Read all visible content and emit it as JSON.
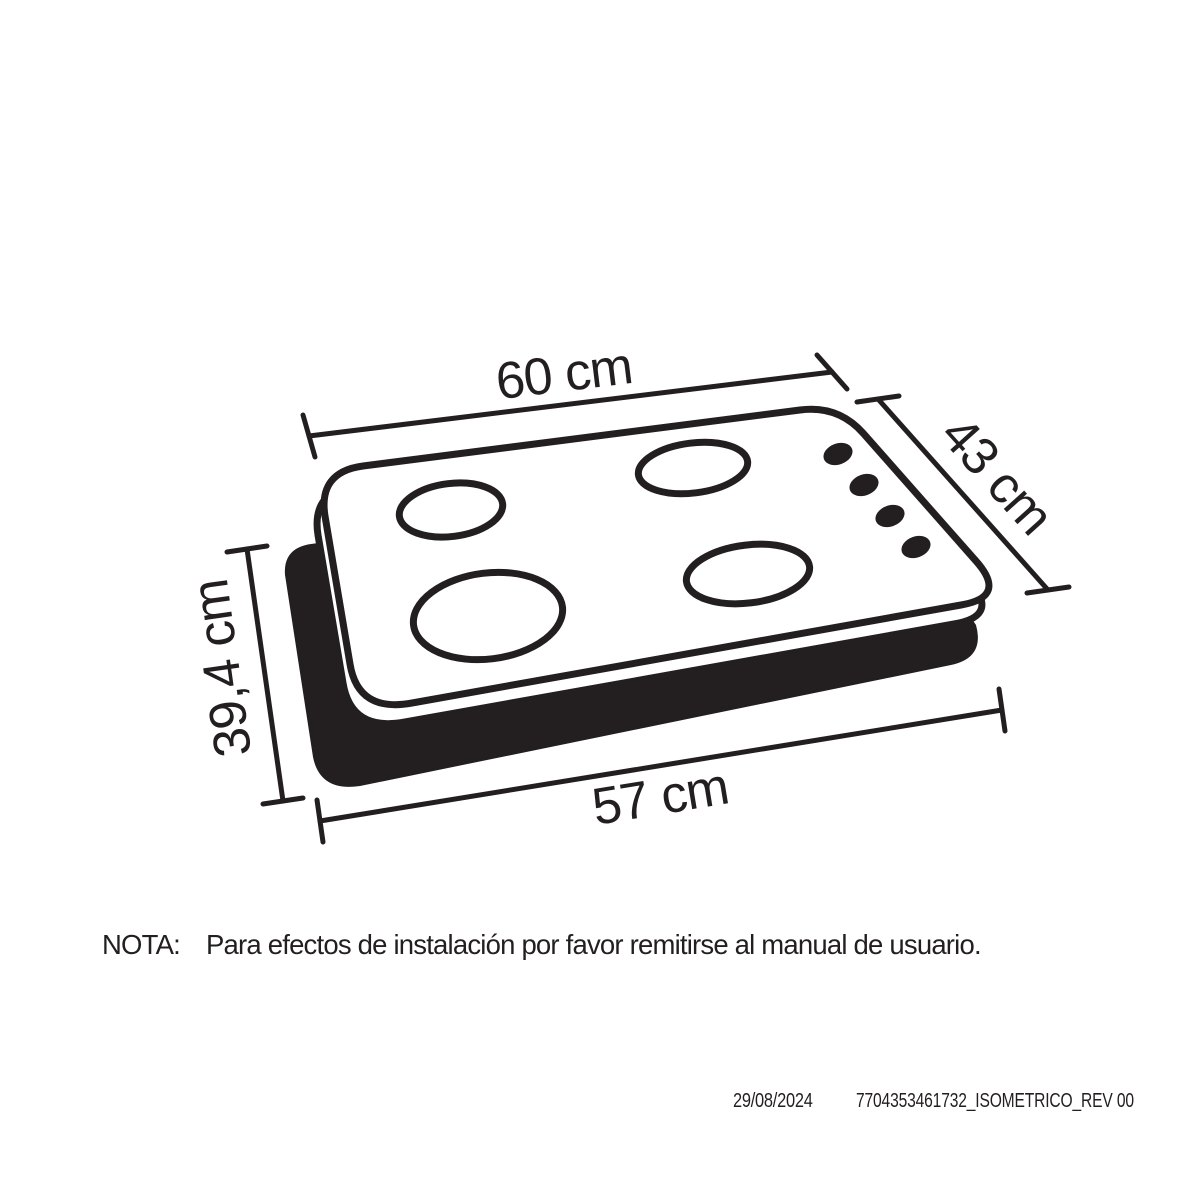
{
  "page": {
    "background": "#ffffff",
    "ink": "#231f20"
  },
  "diagram": {
    "description": "Isometric line drawing of a 4-burner gas cooktop floating above its dark base/cutout silhouette",
    "burner_count": 4,
    "knob_count": 4,
    "dimensions": {
      "top_width": "60 cm",
      "top_depth": "43 cm",
      "cutout_depth": "39,4 cm",
      "cutout_width": "57 cm"
    }
  },
  "note": {
    "label": "NOTA:",
    "text": "Para efectos de instalación por favor remitirse al manual de usuario."
  },
  "footer": {
    "date": "29/08/2024",
    "reference": "7704353461732_ISOMETRICO_REV 00"
  }
}
